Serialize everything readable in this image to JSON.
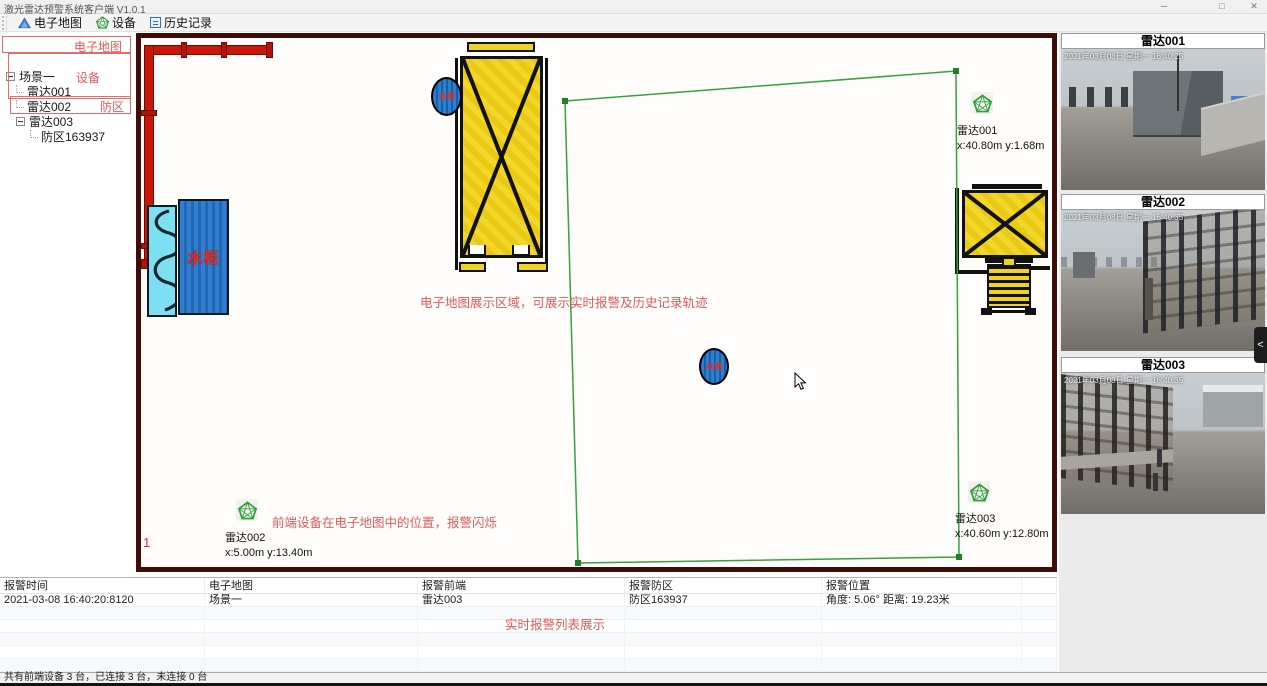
{
  "window": {
    "title": "激光雷达预警系统客户端 V1.0.1",
    "minimize": "─",
    "maximize": "□",
    "close": "✕"
  },
  "toolbar": {
    "items": [
      {
        "label": "电子地图"
      },
      {
        "label": "设备"
      },
      {
        "label": "历史记录"
      }
    ]
  },
  "tree": {
    "items": [
      {
        "label": "场景一"
      },
      {
        "label": "雷达001"
      },
      {
        "label": "雷达002"
      },
      {
        "label": "雷达003"
      },
      {
        "label": "防区163937"
      }
    ],
    "annotations": {
      "map": "电子地图",
      "device": "设备",
      "zone": "防区"
    }
  },
  "map": {
    "water_cabinet_label": "水柜",
    "water_tower_label": "水塔",
    "index_marker": "1",
    "radars": [
      {
        "name": "雷达001",
        "coords": "x:40.80m y:1.68m"
      },
      {
        "name": "雷达002",
        "coords": "x:5.00m y:13.40m"
      },
      {
        "name": "雷达003",
        "coords": "x:40.60m y:12.80m"
      }
    ],
    "annotations": {
      "area": "电子地图展示区域，可展示实时报警及历史记录轨迹",
      "devices": "前端设备在电子地图中的位置，报警闪烁"
    }
  },
  "cameras": {
    "items": [
      {
        "title": "雷达001",
        "timestamp": "2021年03月08日 星期一 16:40:25"
      },
      {
        "title": "雷达002",
        "timestamp": "2021年03月08日 星期一 16:40:35"
      },
      {
        "title": "雷达003",
        "timestamp": "2021年03月08日 星期一 16:40:35"
      }
    ],
    "annotation": "摄像机预览模块，报警闪烁",
    "collapse_glyph": "<"
  },
  "alarm_table": {
    "headers": [
      "报警时间",
      "电子地图",
      "报警前端",
      "报警防区",
      "报警位置"
    ],
    "rows": [
      [
        "2021-03-08 16:40:20:8120",
        "场景一",
        "雷达003",
        "防区163937",
        "角度: 5.06° 距离: 19.23米"
      ]
    ],
    "annotation": "实时报警列表展示"
  },
  "status_bar": {
    "text": "共有前端设备 3 台，已连接 3 台，未连接 0 台"
  },
  "colors": {
    "accent_green": "#2f9e38",
    "annotation_red": "#e05a5a",
    "map_border": "#3f0d08",
    "pipe_red": "#c9170b",
    "structure_yellow": "#f0d222",
    "water_blue": "#2d7fd3",
    "water_cyan": "#7ce0f2",
    "marker_blue": "#2a7fd0"
  }
}
